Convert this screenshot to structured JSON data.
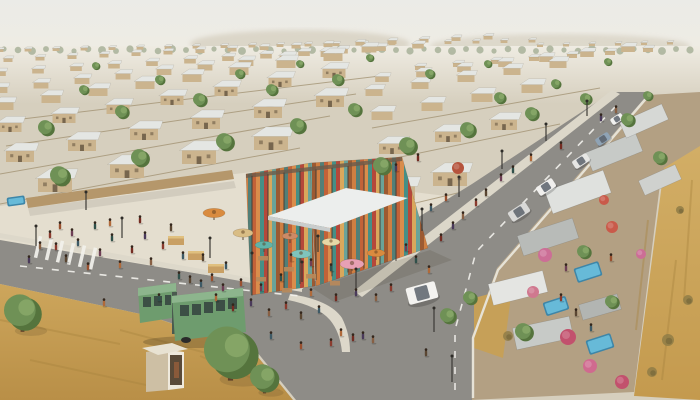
{
  "meta": {
    "description": "Aerial 3D rendering of a planned desert township: uniform rows of small gable-roof houses receding to hazy hills, a central community pavilion built of colorful vertical slats with a white canopy, market umbrellas and a crowded light plaza, streets with pedestrians and crosswalk, a green articulated bus and bus shelter, cars on a diagonal road, walled courtyards with small blue pools and pink flowering shrubs on the right, and golden dry grassland at the edges.",
    "width": 700,
    "height": 400
  },
  "palette": {
    "sky_top": "#ebebe7",
    "sky_bottom": "#efece3",
    "hill": "#d5cfbf",
    "ground": "#d6cfbe",
    "plaza": "#e4decf",
    "road": "#8e8c87",
    "road_line": "#f2f1ec",
    "sidewalk": "#ddd8ca",
    "wall_tan": "#b5976b",
    "house_wall": "#cbb48e",
    "house_roof": "#e4e6e3",
    "house_door": "#77664e",
    "tree_green": "#6f9156",
    "tree_dark": "#55743d",
    "tree_light": "#8fae6d",
    "grass_gold1": "#cda65c",
    "grass_gold2": "#b98f47",
    "field_gold1": "#d2ae66",
    "field_gold2": "#c49a4e",
    "compound_tan": "#b3a083",
    "bus_green": "#6e9c6e",
    "bus_roof": "#8db58d",
    "bus_window": "#3c4f45",
    "pool_blue": "#3e86a8",
    "pool_light": "#6cc0dd",
    "canopy_white": "#eceeed",
    "slat_colors": [
      "#c26238",
      "#d98d4c",
      "#468f86",
      "#b5483a",
      "#d9a85c",
      "#6aa399",
      "#9c5a32",
      "#cf7f42",
      "#527f77"
    ]
  },
  "scene": {
    "treeline": {
      "y": 50,
      "step": 14,
      "r": 2.6,
      "color": "#9aa58a"
    },
    "houses": {
      "rows": [
        [
          0,
          52,
          20,
          28,
          -0.5,
          0.34
        ],
        [
          540,
          47,
          6,
          26,
          -0.5,
          0.3
        ],
        [
          8,
          62,
          16,
          32,
          -1.5,
          0.45
        ],
        [
          420,
          70,
          7,
          38,
          -3,
          0.5
        ],
        [
          0,
          76,
          12,
          38,
          -2.5,
          0.58
        ],
        [
          382,
          82,
          7,
          41,
          -5,
          0.68
        ],
        [
          0,
          93,
          10,
          41,
          -4.5,
          0.74
        ],
        [
          374,
          96,
          5,
          46,
          -7,
          0.85
        ],
        [
          4,
          110,
          8,
          47,
          -7,
          0.95
        ],
        [
          382,
          120,
          4,
          50,
          -9,
          1.05
        ],
        [
          10,
          132,
          7,
          54,
          -9,
          1.15
        ],
        [
          392,
          154,
          3,
          56,
          -12,
          1.3
        ],
        [
          20,
          162,
          6,
          62,
          -11,
          1.4
        ],
        [
          398,
          200,
          2,
          52,
          -14,
          1.7
        ],
        [
          55,
          192,
          4,
          72,
          -14,
          1.7
        ]
      ]
    },
    "fences": [
      [
        0,
        204,
        300,
        148
      ],
      [
        0,
        174,
        330,
        116
      ],
      [
        6,
        146,
        356,
        94
      ],
      [
        14,
        120,
        380,
        76
      ],
      [
        378,
        212,
        470,
        190
      ],
      [
        376,
        162,
        560,
        124
      ],
      [
        372,
        128,
        600,
        88
      ]
    ],
    "trees": [
      [
        22,
        312,
        18
      ],
      [
        230,
        352,
        26
      ],
      [
        264,
        378,
        14
      ],
      [
        60,
        176,
        10
      ],
      [
        140,
        158,
        9
      ],
      [
        225,
        142,
        9
      ],
      [
        298,
        126,
        8
      ],
      [
        355,
        110,
        7
      ],
      [
        46,
        128,
        8
      ],
      [
        122,
        112,
        7
      ],
      [
        200,
        100,
        7
      ],
      [
        272,
        90,
        6
      ],
      [
        338,
        80,
        6
      ],
      [
        408,
        146,
        9
      ],
      [
        468,
        130,
        8
      ],
      [
        532,
        114,
        7
      ],
      [
        586,
        99,
        6
      ],
      [
        628,
        120,
        7
      ],
      [
        382,
        166,
        9
      ],
      [
        500,
        98,
        6
      ],
      [
        556,
        84,
        5
      ],
      [
        160,
        80,
        5
      ],
      [
        84,
        90,
        5
      ],
      [
        240,
        74,
        5
      ],
      [
        430,
        74,
        5
      ],
      [
        488,
        64,
        4
      ],
      [
        608,
        62,
        4
      ],
      [
        660,
        158,
        7
      ],
      [
        524,
        332,
        9
      ],
      [
        470,
        298,
        7
      ],
      [
        584,
        252,
        7
      ],
      [
        612,
        302,
        7
      ],
      [
        648,
        96,
        5
      ],
      [
        96,
        66,
        4
      ],
      [
        300,
        64,
        4
      ],
      [
        370,
        58,
        4
      ],
      [
        448,
        316,
        8
      ]
    ],
    "shrubs": [
      [
        668,
        340,
        6
      ],
      [
        688,
        300,
        5
      ],
      [
        652,
        372,
        5
      ],
      [
        680,
        210,
        4
      ],
      [
        508,
        336,
        5
      ]
    ],
    "streaks": [
      [
        0,
        320,
        120,
        344
      ],
      [
        30,
        360,
        160,
        388
      ],
      [
        120,
        330,
        240,
        362
      ],
      [
        200,
        356,
        280,
        390
      ],
      [
        648,
        220,
        636,
        330
      ],
      [
        676,
        260,
        662,
        380
      ],
      [
        692,
        180,
        684,
        300
      ]
    ],
    "people": {
      "colors": [
        "#8a3b2e",
        "#5a4632",
        "#3e5a66",
        "#99502f",
        "#6e3f55",
        "#30504a",
        "#b06a3a",
        "#742c22",
        "#4a3a5a",
        "#886044"
      ],
      "positions": [
        [
          56,
          250
        ],
        [
          66,
          262
        ],
        [
          78,
          246
        ],
        [
          88,
          270
        ],
        [
          100,
          256
        ],
        [
          112,
          241
        ],
        [
          120,
          268
        ],
        [
          132,
          253
        ],
        [
          145,
          239
        ],
        [
          151,
          265
        ],
        [
          163,
          249
        ],
        [
          171,
          231
        ],
        [
          183,
          259
        ],
        [
          60,
          229
        ],
        [
          72,
          236
        ],
        [
          95,
          229
        ],
        [
          110,
          226
        ],
        [
          140,
          223
        ],
        [
          29,
          263
        ],
        [
          40,
          249
        ],
        [
          50,
          238
        ],
        [
          190,
          283
        ],
        [
          201,
          287
        ],
        [
          212,
          281
        ],
        [
          223,
          291
        ],
        [
          179,
          279
        ],
        [
          216,
          301
        ],
        [
          233,
          311
        ],
        [
          251,
          306
        ],
        [
          269,
          316
        ],
        [
          286,
          309
        ],
        [
          301,
          319
        ],
        [
          319,
          313
        ],
        [
          241,
          286
        ],
        [
          261,
          291
        ],
        [
          281,
          281
        ],
        [
          311,
          296
        ],
        [
          336,
          301
        ],
        [
          356,
          296
        ],
        [
          376,
          301
        ],
        [
          391,
          291
        ],
        [
          203,
          261
        ],
        [
          226,
          269
        ],
        [
          291,
          261
        ],
        [
          311,
          266
        ],
        [
          331,
          271
        ],
        [
          341,
          336
        ],
        [
          353,
          341
        ],
        [
          363,
          339
        ],
        [
          373,
          343
        ],
        [
          331,
          346
        ],
        [
          426,
          356
        ],
        [
          271,
          339
        ],
        [
          301,
          349
        ],
        [
          406,
          251
        ],
        [
          416,
          263
        ],
        [
          429,
          273
        ],
        [
          441,
          241
        ],
        [
          453,
          229
        ],
        [
          463,
          219
        ],
        [
          476,
          206
        ],
        [
          486,
          196
        ],
        [
          431,
          211
        ],
        [
          446,
          201
        ],
        [
          501,
          181
        ],
        [
          513,
          173
        ],
        [
          531,
          161
        ],
        [
          561,
          149
        ],
        [
          601,
          121
        ],
        [
          616,
          113
        ],
        [
          561,
          301
        ],
        [
          576,
          316
        ],
        [
          591,
          331
        ],
        [
          611,
          261
        ],
        [
          566,
          271
        ],
        [
          159,
          301
        ],
        [
          104,
          306
        ],
        [
          418,
          161
        ],
        [
          396,
          171
        ]
      ]
    },
    "cars": [
      [
        519,
        212,
        21,
        11,
        -33,
        "#d9d9d7"
      ],
      [
        546,
        187,
        19,
        10,
        -33,
        "#f0efed"
      ],
      [
        581,
        161,
        17,
        9,
        -33,
        "#e6e6e4"
      ],
      [
        603,
        139,
        15,
        8,
        -33,
        "#8fa3b5"
      ],
      [
        617,
        119,
        13,
        7,
        -33,
        "#f2f2f0"
      ],
      [
        422,
        293,
        30,
        17,
        -15,
        "#f4f3f0"
      ]
    ],
    "pools": [
      [
        16,
        201,
        18,
        9,
        -8
      ],
      [
        588,
        272,
        26,
        15,
        -18
      ],
      [
        556,
        306,
        24,
        14,
        -18
      ],
      [
        600,
        344,
        26,
        15,
        -18
      ]
    ],
    "flowers": [
      [
        545,
        255,
        7,
        "#cc6e96"
      ],
      [
        568,
        337,
        8,
        "#c2516d"
      ],
      [
        590,
        366,
        7,
        "#d06a8f"
      ],
      [
        612,
        227,
        6,
        "#c95a4a"
      ],
      [
        533,
        292,
        6,
        "#d0788f"
      ],
      [
        622,
        382,
        7,
        "#c2516d"
      ],
      [
        458,
        168,
        6,
        "#b5533c"
      ],
      [
        641,
        254,
        5,
        "#cc6e96"
      ],
      [
        604,
        200,
        5,
        "#c95a4a"
      ]
    ],
    "roofs": [
      [
        578,
        192,
        62,
        24,
        -20,
        "#dfe1de"
      ],
      [
        614,
        152,
        54,
        20,
        -22,
        "#c7cac7"
      ],
      [
        644,
        121,
        46,
        17,
        -24,
        "#d6d8d5"
      ],
      [
        548,
        237,
        58,
        21,
        -18,
        "#b8bbb8"
      ],
      [
        518,
        288,
        56,
        22,
        -14,
        "#e4e5e2"
      ],
      [
        543,
        333,
        58,
        22,
        -12,
        "#c7cac7"
      ],
      [
        600,
        307,
        40,
        16,
        -16,
        "#b2b5b2"
      ],
      [
        660,
        180,
        40,
        16,
        -24,
        "#cfd1ce"
      ]
    ],
    "umbrellas": [
      [
        214,
        213,
        11,
        "#d98b3f"
      ],
      [
        243,
        233,
        10,
        "#d9bd85"
      ],
      [
        264,
        245,
        9,
        "#5fb3a9"
      ],
      [
        301,
        254,
        10,
        "#7fc4bc"
      ],
      [
        352,
        264,
        12,
        "#e8a0b4"
      ],
      [
        331,
        242,
        9,
        "#e6d8a6"
      ],
      [
        376,
        253,
        9,
        "#d98b3f"
      ],
      [
        290,
        236,
        8,
        "#cc8a66"
      ]
    ],
    "stalls": [
      [
        168,
        236
      ],
      [
        188,
        251
      ],
      [
        208,
        264
      ]
    ],
    "tables": [
      [
        258,
        256
      ],
      [
        284,
        267
      ],
      [
        306,
        274
      ],
      [
        256,
        277
      ],
      [
        330,
        281
      ],
      [
        282,
        288
      ]
    ],
    "lamps": [
      [
        122,
        238,
        20
      ],
      [
        210,
        258,
        20
      ],
      [
        302,
        282,
        20
      ],
      [
        356,
        291,
        22
      ],
      [
        422,
        231,
        22
      ],
      [
        459,
        197,
        20
      ],
      [
        502,
        169,
        18
      ],
      [
        546,
        141,
        17
      ],
      [
        587,
        116,
        15
      ],
      [
        36,
        246,
        20
      ],
      [
        252,
        273,
        20
      ],
      [
        434,
        332,
        24
      ],
      [
        452,
        382,
        26
      ],
      [
        86,
        210,
        18
      ],
      [
        318,
        252,
        16
      ]
    ],
    "posts": {
      "xs": [
        252,
        268,
        284,
        300,
        316,
        332,
        348,
        364,
        380,
        396
      ]
    },
    "crosswalk": {
      "x": 38,
      "y": 247,
      "dx": 11,
      "dy": 2.3,
      "n": 6,
      "w": 3.5,
      "h": 22,
      "rot": 13
    },
    "dashes": [
      "20,266 300,296",
      "616,106 476,252 455,330 455,398"
    ]
  }
}
